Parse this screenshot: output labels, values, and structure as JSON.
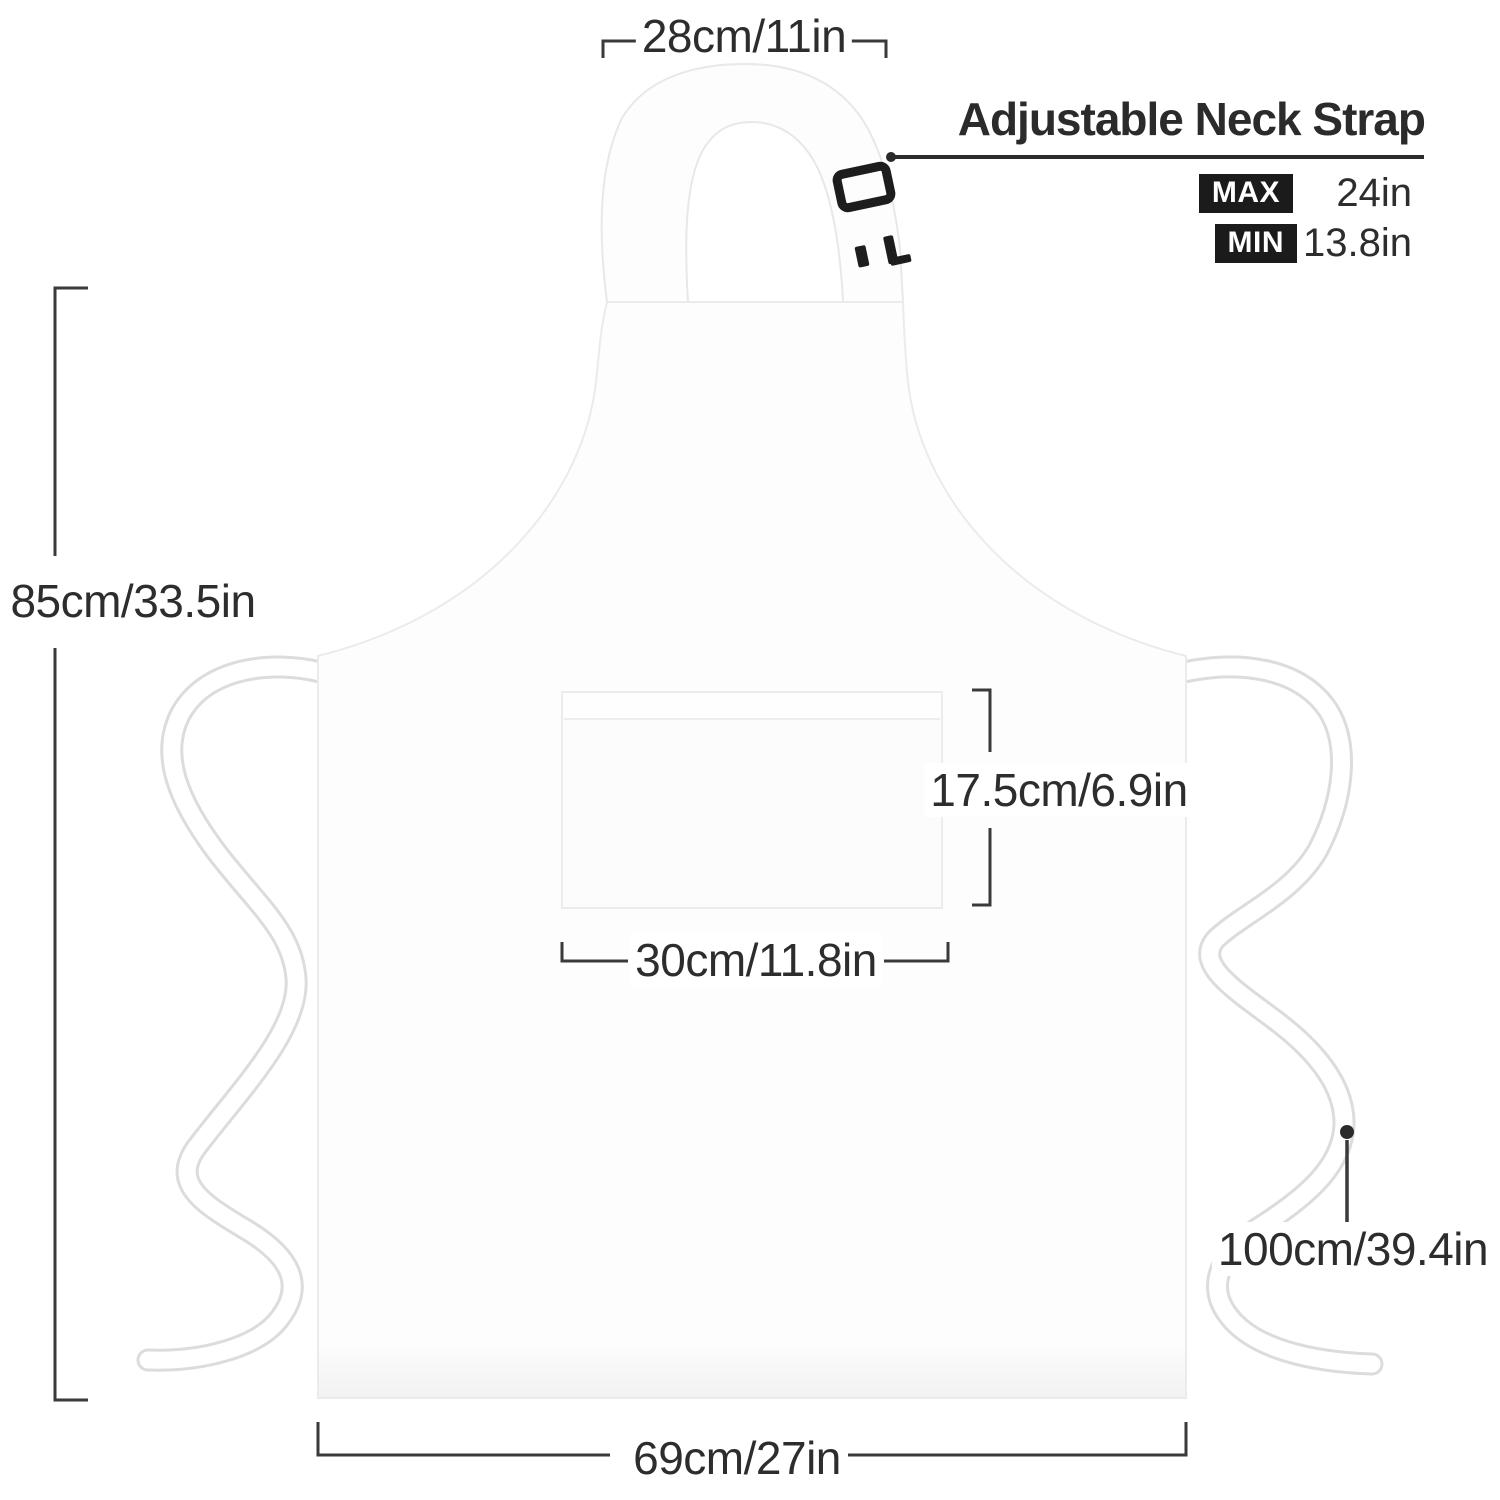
{
  "page": {
    "type": "product-dimension-diagram",
    "subject": "white bib apron with front pocket, neck strap and waist ties"
  },
  "dimensions": {
    "neck_strap_width": "28cm/11in",
    "apron_height": "85cm/33.5in",
    "pocket_height": "17.5cm/6.9in",
    "pocket_width": "30cm/11.8in",
    "waist_tie_length": "100cm/39.4in",
    "apron_width": "69cm/27in"
  },
  "neck_strap_callout": {
    "heading": "Adjustable Neck Strap",
    "rows": [
      {
        "label": "MAX",
        "value": "24in"
      },
      {
        "label": "MIN",
        "value": "13.8in"
      }
    ]
  },
  "colors": {
    "annotation_text": "#2d2d2d",
    "annotation_line": "#3a3a3a",
    "badge_background": "#1b1b1b",
    "badge_text": "#ffffff",
    "apron_fill": "#fdfdfd",
    "apron_outline": "#eaeaea",
    "buckle": "#1d1d1d"
  }
}
